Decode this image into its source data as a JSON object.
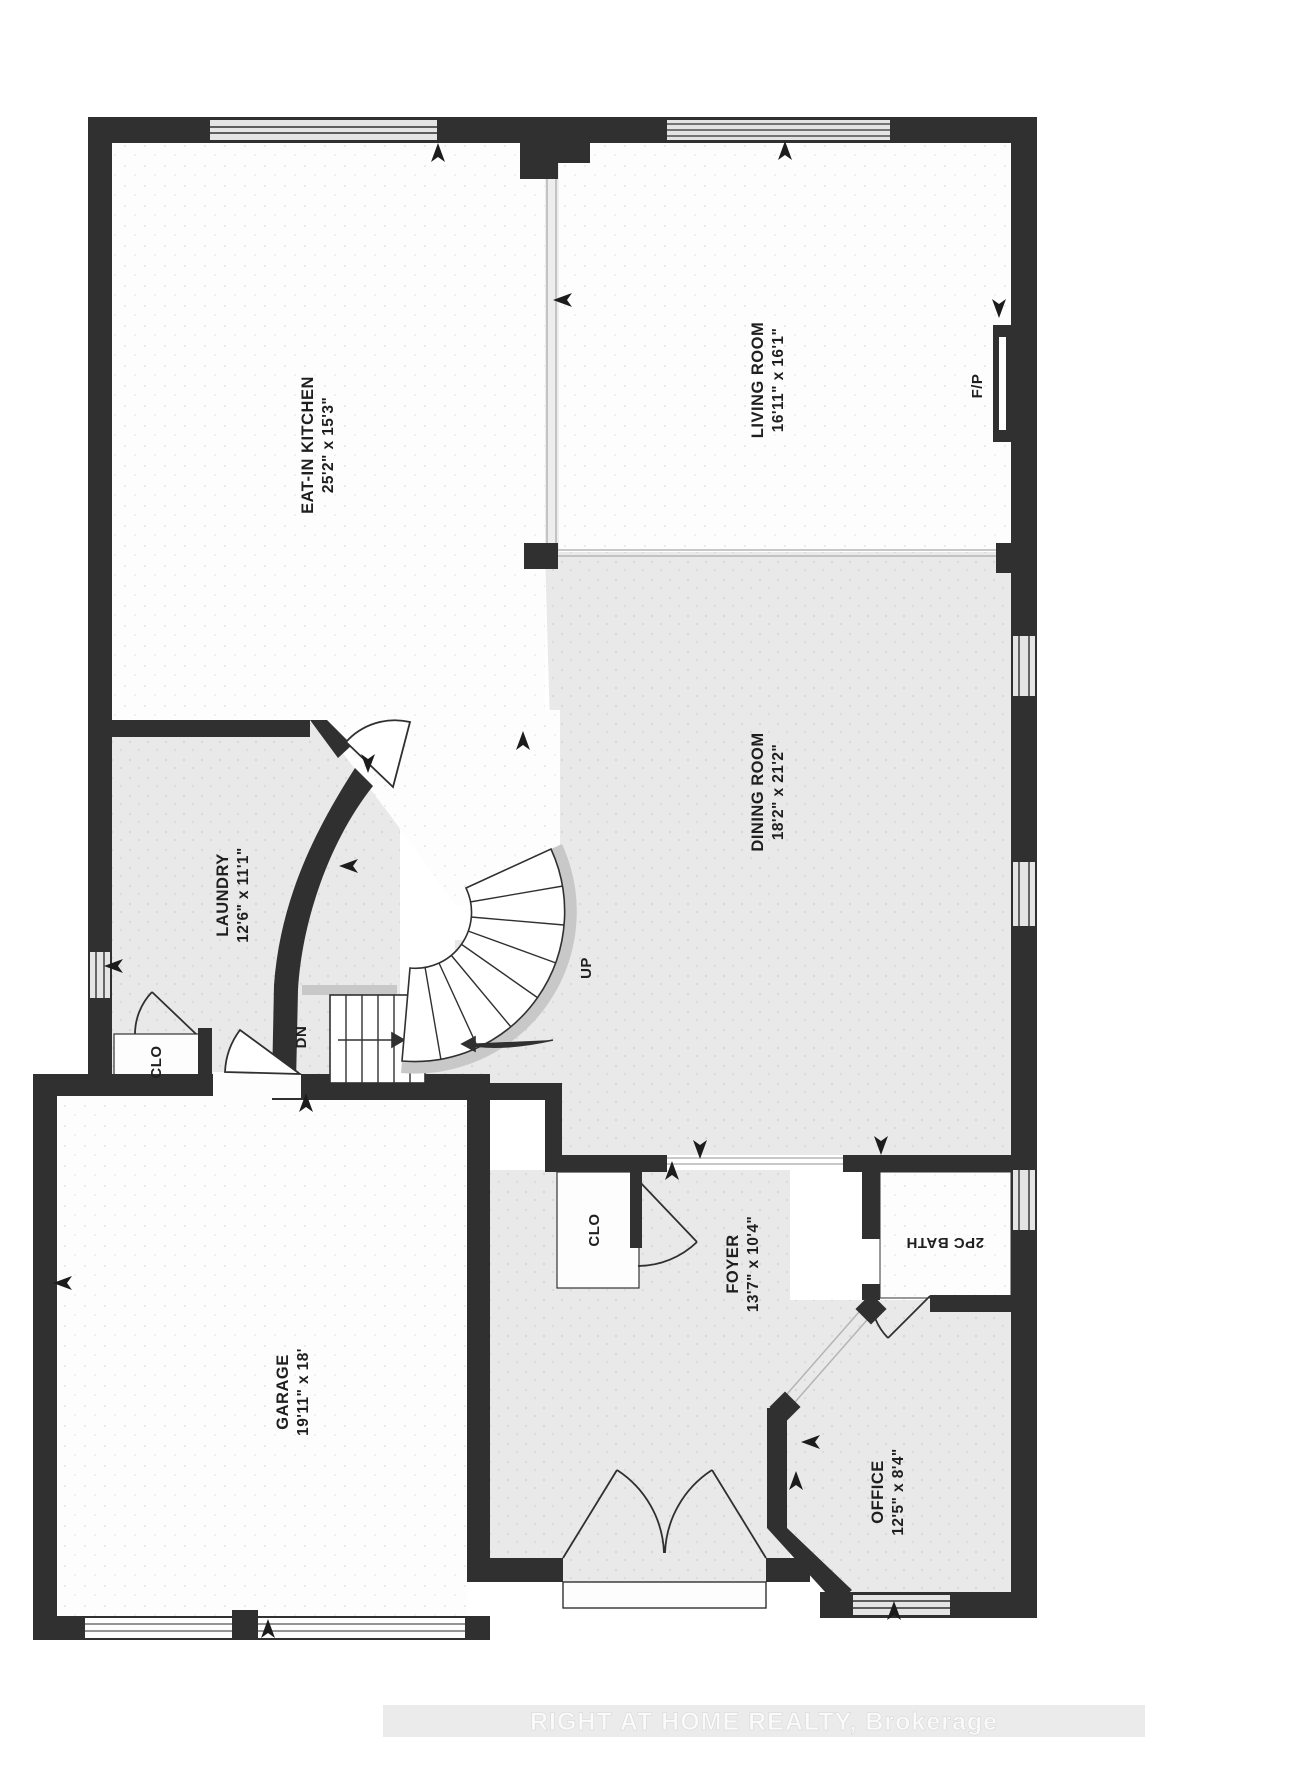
{
  "title": "Main floor plan",
  "colors": {
    "wall": "#303030",
    "floor_gray": "#e9e9e9",
    "floor_white": "#fdfdfd",
    "window_band": "#e4e4e4",
    "stair_rail": "#c8c8c8",
    "label_text": "#1f1f1f",
    "watermark_band": "#ebebeb",
    "watermark_text": "#fafafa"
  },
  "rooms": {
    "kitchen": {
      "name": "EAT-IN KITCHEN",
      "dims": "25'2\" x 15'3\""
    },
    "living": {
      "name": "LIVING ROOM",
      "dims": "16'11\" x 16'1\""
    },
    "dining": {
      "name": "DINING ROOM",
      "dims": "18'2\" x 21'2\""
    },
    "laundry": {
      "name": "LAUNDRY",
      "dims": "12'6\" x 11'1\""
    },
    "garage": {
      "name": "GARAGE",
      "dims": "19'11\" x 18'"
    },
    "foyer": {
      "name": "FOYER",
      "dims": "13'7\" x 10'4\""
    },
    "bath": {
      "name": "2PC BATH"
    },
    "office": {
      "name": "OFFICE",
      "dims": "12'5\" x 8'4\""
    }
  },
  "annotations": {
    "closet_a": "CLO",
    "closet_b": "CLO",
    "stairs_up": "UP",
    "stairs_down": "DN",
    "fireplace": "F/P"
  },
  "watermark": {
    "brand": "RIGHT AT HOME REALTY, Brokerage"
  }
}
